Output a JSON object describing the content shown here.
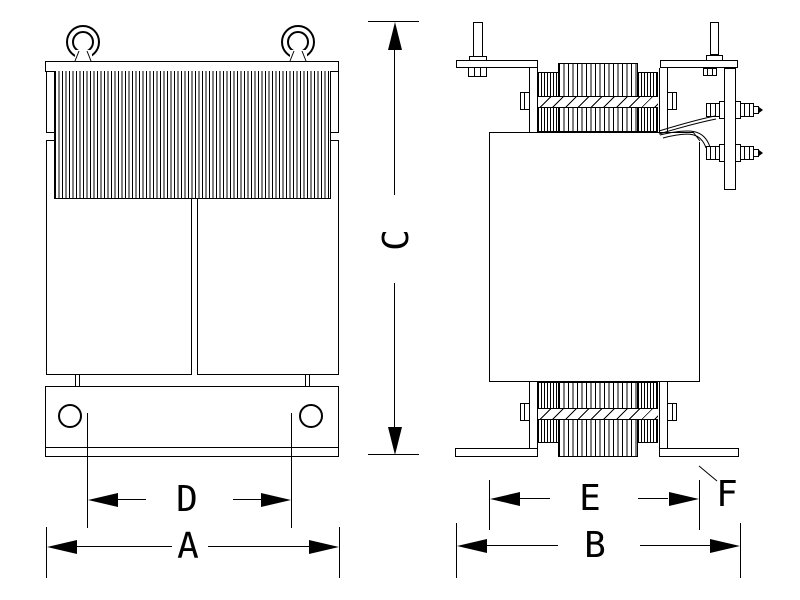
{
  "colors": {
    "background": "#FFFFFF",
    "line": "#000000"
  },
  "dimensions": {
    "overall_height": {
      "label": "C"
    },
    "front_overall_width": {
      "label": "A"
    },
    "front_hole_spacing": {
      "label": "D"
    },
    "side_overall_width": {
      "label": "B"
    },
    "side_core_depth": {
      "label": "E"
    },
    "foot_reference": {
      "label": "F"
    }
  }
}
